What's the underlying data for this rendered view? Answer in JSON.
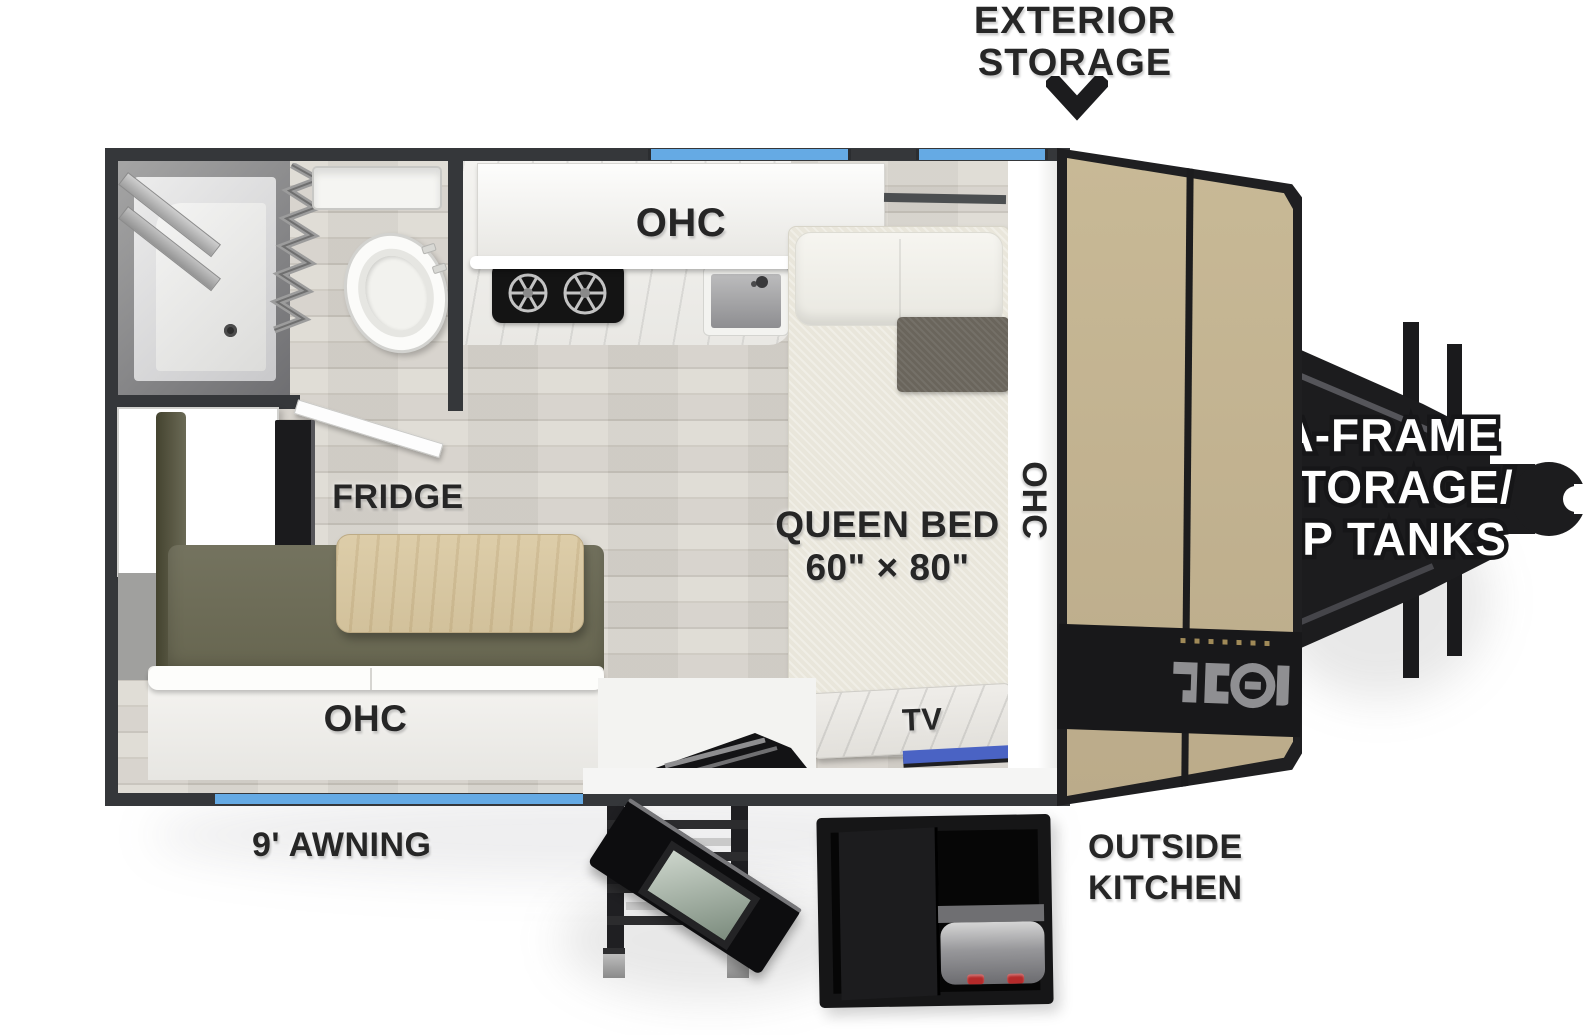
{
  "exterior": {
    "storage_label": {
      "line1": "EXTERIOR",
      "line2": "STORAGE"
    },
    "awning_label": "9' AWNING",
    "outside_kitchen_label": {
      "line1": "OUTSIDE",
      "line2": "KITCHEN"
    },
    "aframe_label": {
      "line1": "A-FRAME",
      "line2": "STORAGE/",
      "line3": "LP TANKS"
    }
  },
  "interior": {
    "kitchen": {
      "ohc_label": "OHC"
    },
    "dinette": {
      "ohc_label": "OHC",
      "fridge_label": "FRIDGE"
    },
    "bedroom": {
      "ohc_label": "OHC",
      "tv_label": "TV",
      "bed_label": {
        "line1": "QUEEN BED",
        "line2": "60\" × 80\""
      }
    }
  },
  "colors": {
    "wall_dark": "#35373a",
    "window_blue": "#65aae4",
    "tv_window_blue": "#4a63c4",
    "front_storage_tan": "#c3b394",
    "sofa_olive": "#6b6a56",
    "table_wood": "#d8c8a4",
    "label_dark": "#262626"
  }
}
